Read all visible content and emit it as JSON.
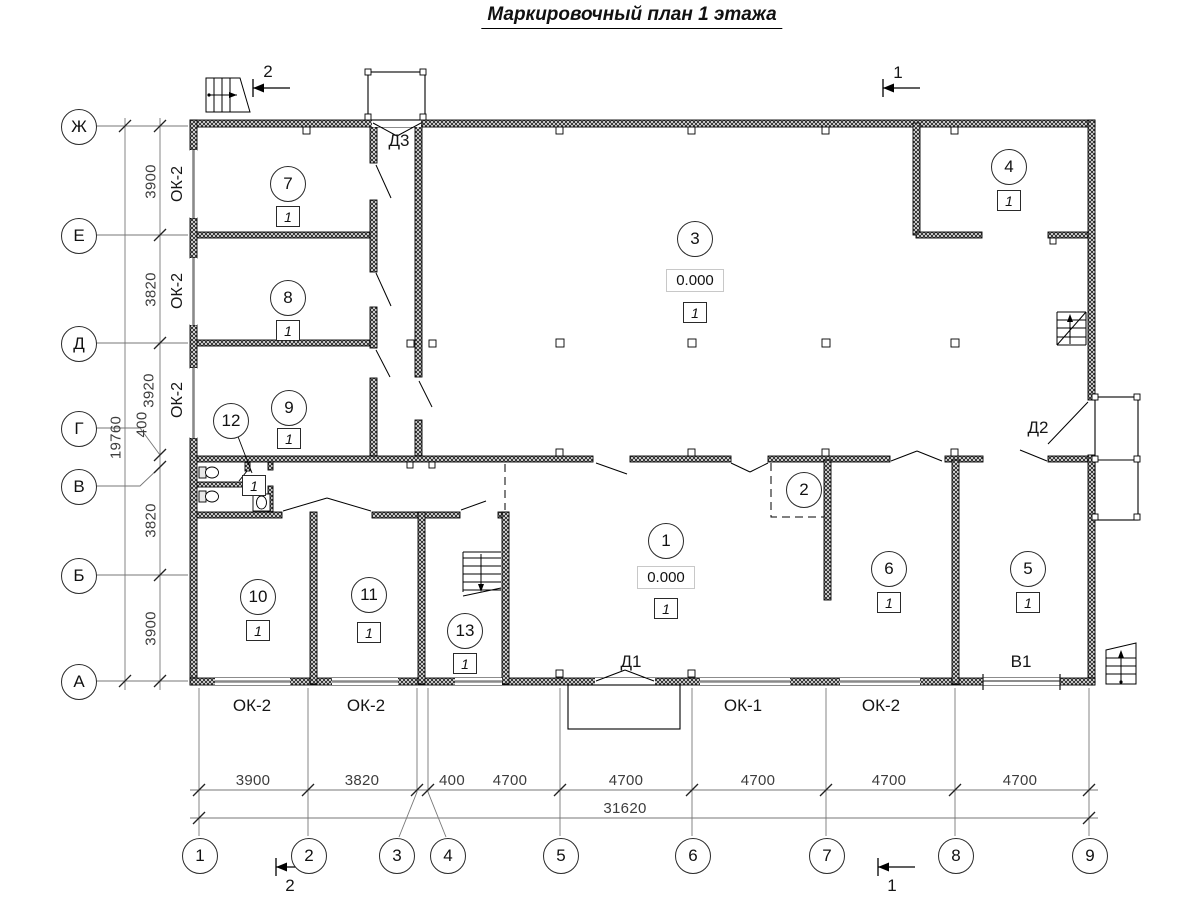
{
  "title": "Маркировочный план 1 этажа",
  "axes": {
    "rows": [
      "Ж",
      "Е",
      "Д",
      "Г",
      "В",
      "Б",
      "А"
    ],
    "cols": [
      "1",
      "2",
      "3",
      "4",
      "5",
      "6",
      "7",
      "8",
      "9"
    ]
  },
  "dims": {
    "left": [
      "3900",
      "3820",
      "3920",
      "400",
      "3820",
      "3900"
    ],
    "left_total": "19760",
    "bottom": [
      "3900",
      "3820",
      "400",
      "4700",
      "4700",
      "4700",
      "4700",
      "4700"
    ],
    "bottom_total": "31620"
  },
  "rooms": [
    {
      "num": "7",
      "cat": "1"
    },
    {
      "num": "8",
      "cat": "1"
    },
    {
      "num": "9",
      "cat": "1"
    },
    {
      "num": "12",
      "cat": "1"
    },
    {
      "num": "10",
      "cat": "1"
    },
    {
      "num": "11",
      "cat": "1"
    },
    {
      "num": "13",
      "cat": "1"
    },
    {
      "num": "1",
      "cat": "1",
      "elevation": "0.000"
    },
    {
      "num": "2"
    },
    {
      "num": "3",
      "cat": "1",
      "elevation": "0.000"
    },
    {
      "num": "4",
      "cat": "1"
    },
    {
      "num": "5",
      "cat": "1"
    },
    {
      "num": "6",
      "cat": "1"
    }
  ],
  "labels": {
    "window_ok2": "ОК-2",
    "window_ok1": "ОК-1",
    "door_d1": "Д1",
    "door_d2": "Д2",
    "door_d3": "Д3",
    "gate_v1": "В1",
    "section_1": "1",
    "section_2": "2"
  },
  "colors": {
    "line": "#000000",
    "dim_text": "#3d3d3d",
    "window": "#8a8a8a"
  }
}
